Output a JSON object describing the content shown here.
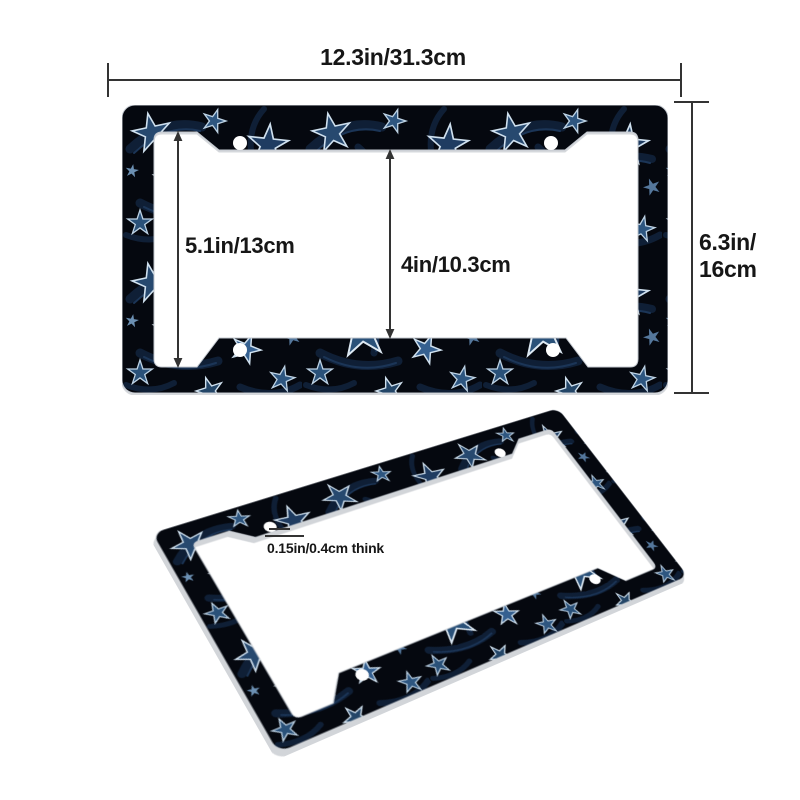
{
  "scene": {
    "background_color": "#ffffff",
    "subject": "license-plate-frame dimension diagram",
    "views": [
      "front-view-with-dimensions",
      "tilted-perspective-view"
    ]
  },
  "annotations": {
    "width_label": "12.3in/31.3cm",
    "height_label_lines": [
      "6.3in/",
      "16cm"
    ],
    "inner_height_label": "5.1in/13cm",
    "plate_opening_label": "4in/10.3cm",
    "thickness_label": "0.15in/0.4cm think",
    "line_color": "#333333",
    "text_color": "#161616"
  },
  "frame": {
    "pattern": "navy blue stars with light outlines on dark leafy background",
    "colors": {
      "base": "#05080f",
      "leaf_dark": "#0f1f36",
      "leaf_light": "#1b3557",
      "star_fills": [
        "#27496f",
        "#2e5680",
        "#1f3c61",
        "#2a5179",
        "#356090",
        "#244668"
      ],
      "star_outline": "#cfe0ee",
      "star_accent": "#6c90b3",
      "screw_hole": "#ffffff",
      "edge": "#c3c8cf"
    }
  }
}
